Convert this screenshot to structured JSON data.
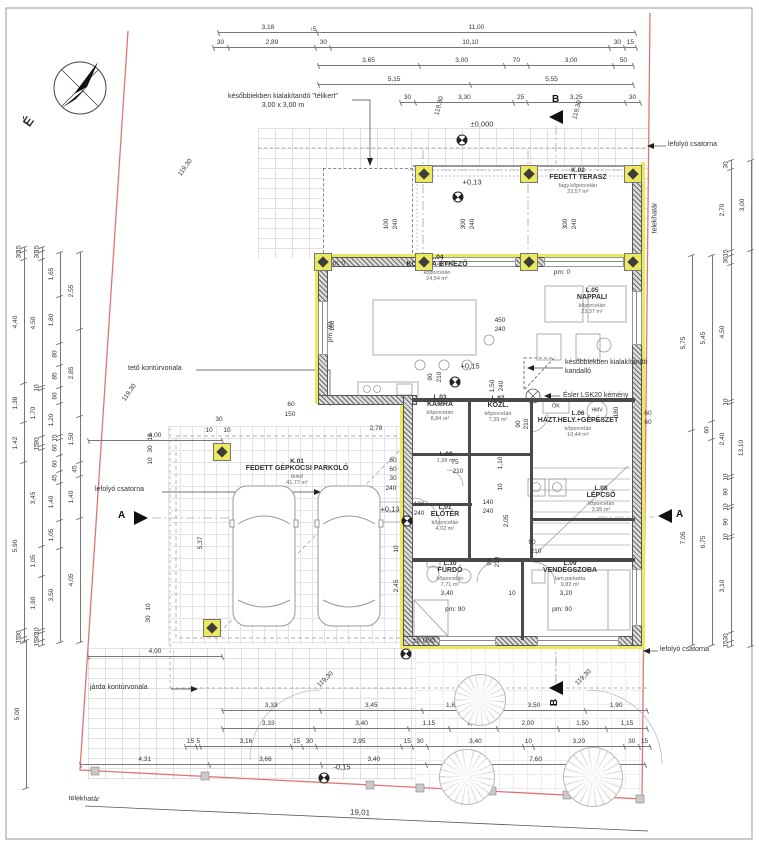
{
  "compass": {
    "north": "É"
  },
  "sections": {
    "a": "A",
    "b": "B"
  },
  "notes": {
    "telikert_1": "későbbiekben kialakítandó \"télikert\"",
    "telikert_2": "3,00 x 3,00 m",
    "kandallo_1": "későbbiekben kialakítandó",
    "kandallo_2": "kandalló",
    "kemeny": "Ésler LSK20 kémény",
    "lefolyo": "lefolyó csatorna",
    "teto": "tető kontúrvonala",
    "jarda": "járda kontúrvonala"
  },
  "rooms": [
    {
      "id": "K.02",
      "name": "FEDETT TERASZ",
      "material": "fagy.kőporcelán",
      "area": "22,57 m²",
      "x": 578,
      "y": 181
    },
    {
      "id": "L.04",
      "name": "KONYHA-ÉTKEZŐ",
      "material": "kőporcelán",
      "area": "24,54 m²",
      "x": 437,
      "y": 268
    },
    {
      "id": "L.05",
      "name": "NAPPALI",
      "material": "kőporcelán",
      "area": "23,37 m²",
      "x": 592,
      "y": 301
    },
    {
      "id": "L.03",
      "name": "KAMRA",
      "material": "kőporcelán",
      "area": "8,84 m²",
      "x": 440,
      "y": 408
    },
    {
      "id": "L.07",
      "name": "KÖZL.",
      "material": "kőporcelán",
      "area": "7,39 m²",
      "x": 498,
      "y": 409
    },
    {
      "id": "L.06",
      "name": "HÁZT.HELY.+GÉPÉSZET",
      "material": "kőporcelán",
      "area": "10,44 m²",
      "x": 578,
      "y": 424
    },
    {
      "id": "L.02",
      "name": "",
      "material": "",
      "area": "1,98 m²",
      "x": 446,
      "y": 458
    },
    {
      "id": "L.01",
      "name": "ELŐTÉR",
      "material": "kőporcelán",
      "area": "4,02 m²",
      "x": 445,
      "y": 518
    },
    {
      "id": "L.08",
      "name": "LÉPCSŐ",
      "material": "kőporcelán",
      "area": "3,95 m²",
      "x": 601,
      "y": 499
    },
    {
      "id": "L.10",
      "name": "FÜRDŐ",
      "material": "kőporcelán",
      "area": "7,71 m²",
      "x": 450,
      "y": 574
    },
    {
      "id": "L.09",
      "name": "VENDÉGSZOBA",
      "material": "lam.parketta",
      "area": "9,82 m²",
      "x": 570,
      "y": 574
    },
    {
      "id": "K.01",
      "name": "FEDETT GÉPKOCSI PARKOLÓ",
      "material": "térkő",
      "area": "41,77 m²",
      "x": 297,
      "y": 472
    }
  ],
  "levels": [
    {
      "t": "±0,000",
      "x": 482,
      "y": 124
    },
    {
      "t": "+0,13",
      "x": 472,
      "y": 182
    },
    {
      "t": "+0,15",
      "x": 470,
      "y": 366
    },
    {
      "t": "+0,13",
      "x": 390,
      "y": 509
    },
    {
      "t": "±0,000",
      "x": 424,
      "y": 640
    },
    {
      "t": "-0,15",
      "x": 342,
      "y": 767
    }
  ],
  "level_symbols": [
    {
      "x": 462,
      "y": 140
    },
    {
      "x": 458,
      "y": 197
    },
    {
      "x": 455,
      "y": 382
    },
    {
      "x": 407,
      "y": 521
    },
    {
      "x": 406,
      "y": 654
    },
    {
      "x": 324,
      "y": 778
    }
  ],
  "columns": [
    {
      "x": 424,
      "y": 174
    },
    {
      "x": 529,
      "y": 174
    },
    {
      "x": 633,
      "y": 174
    },
    {
      "x": 424,
      "y": 262
    },
    {
      "x": 529,
      "y": 262
    },
    {
      "x": 633,
      "y": 262
    },
    {
      "x": 323,
      "y": 262
    },
    {
      "x": 222,
      "y": 452
    },
    {
      "x": 212,
      "y": 628
    }
  ],
  "trees": [
    {
      "x": 480,
      "y": 700,
      "d": 50
    },
    {
      "x": 467,
      "y": 777,
      "d": 54
    },
    {
      "x": 593,
      "y": 777,
      "d": 58
    }
  ],
  "dims": {
    "t1": [
      "3,18",
      "11,00"
    ],
    "t2": [
      "30",
      "2,89",
      "30",
      "10,10",
      "30",
      "15"
    ],
    "t3": [
      "3,65",
      "3,00",
      "70",
      "3,00",
      "50"
    ],
    "t4": [
      "5,15",
      "5,55"
    ],
    "t5": [
      "30",
      "3,30",
      "25",
      "3,25",
      "30"
    ],
    "b1": [
      "3,33",
      "3,45",
      "1,85",
      "3,50",
      "1,90"
    ],
    "b2": [
      "3,33",
      "3,40",
      "1,15",
      "1,50",
      "2,00",
      "1,50",
      "1,15"
    ],
    "b3": [
      "15",
      "5",
      "3,16",
      "15",
      "30",
      "2,95",
      "15",
      "30",
      "3,40",
      "10",
      "3,20",
      "30",
      "15"
    ],
    "b4": [
      "4,31",
      "3,66",
      "3,40",
      "7,60"
    ],
    "b6": [
      "4,00"
    ],
    "b7": [
      "4,00"
    ],
    "l1": [
      "15",
      "30",
      "4,40",
      "1,38",
      "1,42",
      "5,90",
      "30",
      "15"
    ],
    "l2": [
      "15",
      "30",
      "4,50",
      "10",
      "1,70",
      "30",
      "15",
      "3,45",
      "1,05",
      "1,90",
      "10",
      "30",
      "15"
    ],
    "l3": [
      "1,65",
      "1,80",
      "80",
      "85",
      "60",
      "1,20",
      "15",
      "60",
      "60",
      "45",
      "1,40",
      "1,05",
      "3,50"
    ],
    "l4": [
      "2,55",
      "2,85",
      "1,50",
      "45",
      "1,40",
      "4,05"
    ],
    "l5": [
      "5,00"
    ],
    "r1": [
      "5,75",
      "7,05"
    ],
    "r2": [
      "5,45",
      "60",
      "6,75"
    ],
    "r3": [
      "30",
      "2,70",
      "15",
      "30",
      "4,50",
      "10",
      "2,40",
      "10",
      "90",
      "10",
      "90",
      "10",
      "3,10",
      "30",
      "15"
    ],
    "r4": [
      "3,00",
      "13,10"
    ]
  },
  "floating": [
    {
      "t": "↑5",
      "x": 313,
      "y": 30
    },
    {
      "t": "119,30",
      "x": 186,
      "y": 168,
      "r": -55,
      "n": "slope-label"
    },
    {
      "t": "119,30",
      "x": 440,
      "y": 106,
      "r": -75,
      "n": "slope-label"
    },
    {
      "t": "119,30",
      "x": 578,
      "y": 110,
      "r": -75,
      "n": "slope-label"
    },
    {
      "t": "119,30",
      "x": 130,
      "y": 393,
      "r": -55,
      "n": "slope-label"
    },
    {
      "t": "119,30",
      "x": 326,
      "y": 680,
      "r": -45,
      "n": "slope-label"
    },
    {
      "t": "119,30",
      "x": 584,
      "y": 678,
      "r": -45,
      "n": "slope-label"
    },
    {
      "t": "100",
      "x": 387,
      "y": 224,
      "r": -90
    },
    {
      "t": "240",
      "x": 396,
      "y": 224,
      "r": -90
    },
    {
      "t": "300",
      "x": 464,
      "y": 224,
      "r": -90
    },
    {
      "t": "240",
      "x": 473,
      "y": 224,
      "r": -90
    },
    {
      "t": "300",
      "x": 566,
      "y": 224,
      "r": -90
    },
    {
      "t": "240",
      "x": 575,
      "y": 224,
      "r": -90
    },
    {
      "t": "pm: 0",
      "x": 337,
      "y": 264,
      "n": "pm-label"
    },
    {
      "t": "pm: 0",
      "x": 447,
      "y": 264,
      "n": "pm-label"
    },
    {
      "t": "pm: 0",
      "x": 562,
      "y": 273,
      "n": "pm-label"
    },
    {
      "t": "pm: 90",
      "x": 455,
      "y": 610,
      "n": "pm-label"
    },
    {
      "t": "pm: 90",
      "x": 562,
      "y": 610,
      "n": "pm-label"
    },
    {
      "t": "pm: 90",
      "x": 331,
      "y": 332,
      "r": -90,
      "n": "pm-label"
    },
    {
      "t": "450",
      "x": 500,
      "y": 321
    },
    {
      "t": "240",
      "x": 500,
      "y": 330
    },
    {
      "t": "180",
      "x": 333,
      "y": 326,
      "r": -90
    },
    {
      "t": "90",
      "x": 431,
      "y": 377,
      "r": -90
    },
    {
      "t": "210",
      "x": 440,
      "y": 377,
      "r": -90
    },
    {
      "t": "1,50",
      "x": 493,
      "y": 386,
      "r": -90
    },
    {
      "t": "240",
      "x": 502,
      "y": 386,
      "r": -90
    },
    {
      "t": "60",
      "x": 291,
      "y": 405
    },
    {
      "t": "150",
      "x": 290,
      "y": 415
    },
    {
      "t": "30",
      "x": 219,
      "y": 420
    },
    {
      "t": "10",
      "x": 209,
      "y": 431
    },
    {
      "t": "10",
      "x": 227,
      "y": 431
    },
    {
      "t": "2,78",
      "x": 376,
      "y": 429
    },
    {
      "t": "180",
      "x": 617,
      "y": 412,
      "r": -90
    },
    {
      "t": "60",
      "x": 648,
      "y": 414
    },
    {
      "t": "60",
      "x": 648,
      "y": 423
    },
    {
      "t": "90",
      "x": 519,
      "y": 424,
      "r": -90
    },
    {
      "t": "210",
      "x": 527,
      "y": 424,
      "r": -90
    },
    {
      "t": "60",
      "x": 393,
      "y": 461
    },
    {
      "t": "60",
      "x": 393,
      "y": 470
    },
    {
      "t": "30",
      "x": 393,
      "y": 479
    },
    {
      "t": "240",
      "x": 391,
      "y": 489
    },
    {
      "t": "75",
      "x": 455,
      "y": 463
    },
    {
      "t": "210",
      "x": 458,
      "y": 472
    },
    {
      "t": "100",
      "x": 419,
      "y": 505
    },
    {
      "t": "240",
      "x": 419,
      "y": 514
    },
    {
      "t": "140",
      "x": 488,
      "y": 503
    },
    {
      "t": "240",
      "x": 488,
      "y": 512
    },
    {
      "t": "1,10",
      "x": 501,
      "y": 463,
      "r": -90
    },
    {
      "t": "10",
      "x": 501,
      "y": 487,
      "r": -90
    },
    {
      "t": "2,05",
      "x": 507,
      "y": 521,
      "r": -90
    },
    {
      "t": "90",
      "x": 532,
      "y": 543
    },
    {
      "t": "210",
      "x": 536,
      "y": 552
    },
    {
      "t": "90",
      "x": 490,
      "y": 562,
      "r": -90
    },
    {
      "t": "210",
      "x": 498,
      "y": 562,
      "r": -90
    },
    {
      "t": "3,40",
      "x": 447,
      "y": 594
    },
    {
      "t": "10",
      "x": 512,
      "y": 594
    },
    {
      "t": "3,20",
      "x": 566,
      "y": 594
    },
    {
      "t": "10",
      "x": 151,
      "y": 437,
      "r": -90
    },
    {
      "t": "30",
      "x": 151,
      "y": 449,
      "r": -90
    },
    {
      "t": "10",
      "x": 151,
      "y": 461,
      "r": -90
    },
    {
      "t": "5,37",
      "x": 201,
      "y": 543,
      "r": -90
    },
    {
      "t": "10",
      "x": 397,
      "y": 549,
      "r": -90
    },
    {
      "t": "2,45",
      "x": 397,
      "y": 586,
      "r": -90
    },
    {
      "t": "10",
      "x": 149,
      "y": 607,
      "r": -90
    },
    {
      "t": "30",
      "x": 149,
      "y": 619,
      "r": -90
    },
    {
      "t": "ÖK",
      "x": 556,
      "y": 407,
      "s": 5.5,
      "n": "equipment-label"
    },
    {
      "t": "HMV",
      "x": 597,
      "y": 411,
      "s": 5,
      "n": "equipment-label"
    },
    {
      "t": "19,01",
      "x": 360,
      "y": 813,
      "r": 2.3,
      "s": 8,
      "n": "total-dimension"
    },
    {
      "t": "telekhatár",
      "x": 655,
      "y": 218,
      "r": -90,
      "s": 7,
      "n": "boundary-label"
    },
    {
      "t": "telekhatár",
      "x": 84,
      "y": 799,
      "r": 2,
      "s": 7,
      "n": "boundary-label"
    }
  ]
}
